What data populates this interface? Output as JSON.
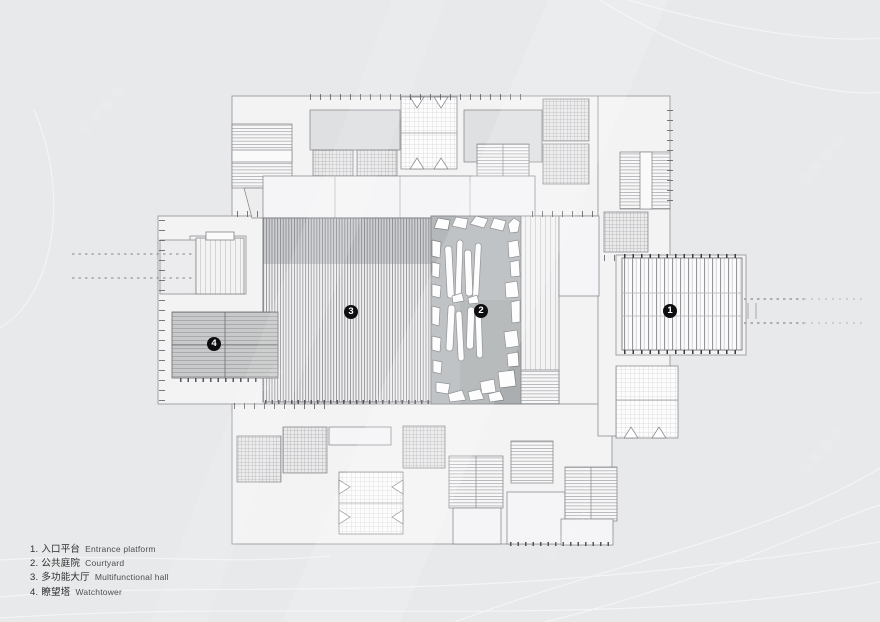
{
  "page": {
    "background": "#e8e9ea",
    "plan_fill": "#f3f3f4",
    "courtyard_fill": "#b4b8ba",
    "tower_fill": "#c7c9ca"
  },
  "legend": {
    "items": [
      {
        "num": "1.",
        "zh": "入口平台",
        "en": "Entrance platform"
      },
      {
        "num": "2.",
        "zh": "公共庭院",
        "en": "Courtyard"
      },
      {
        "num": "3.",
        "zh": "多功能大厅",
        "en": "Multifunctional hall"
      },
      {
        "num": "4.",
        "zh": "瞭望塔",
        "en": "Watchtower"
      }
    ]
  },
  "markers": [
    {
      "label": "1",
      "area": "entrance-platform"
    },
    {
      "label": "2",
      "area": "courtyard"
    },
    {
      "label": "3",
      "area": "multifunctional-hall"
    },
    {
      "label": "4",
      "area": "watchtower"
    }
  ],
  "watermark": {
    "text": "知末案例"
  }
}
